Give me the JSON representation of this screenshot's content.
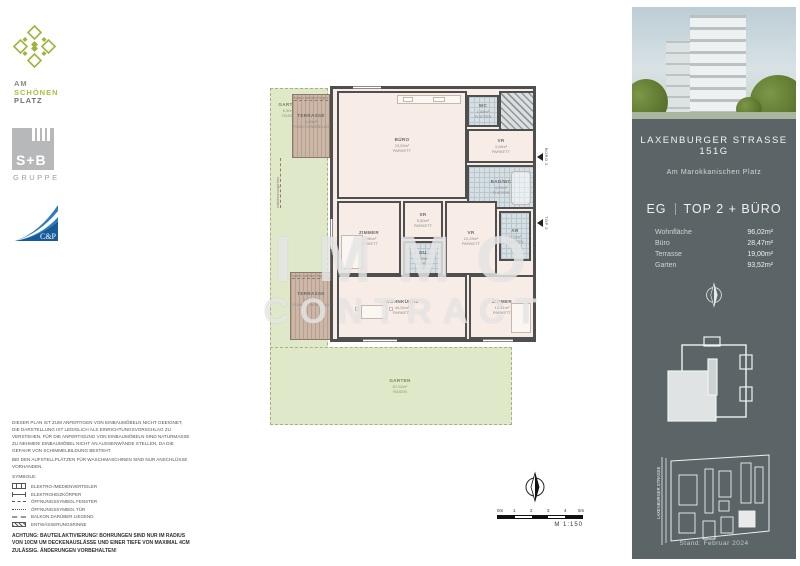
{
  "brand": {
    "asp": {
      "l1": "AM",
      "l2": "SCHÖNEN",
      "l3": "PLATZ"
    },
    "sb_name": "S+B",
    "sb_sub": "GRUPPE",
    "cp": "C&P"
  },
  "plan": {
    "rooms": [
      {
        "name": "BÜRO",
        "area": "23,53m²",
        "floor": "PARKETT"
      },
      {
        "name": "WC",
        "area": "1,88m²",
        "floor": "FLIESEN"
      },
      {
        "name": "VR",
        "area": "3,06m²",
        "floor": "PARKETT"
      },
      {
        "name": "BAD/WC",
        "area": "4,50m²",
        "floor": "FLIESEN"
      },
      {
        "name": "ZIMMER",
        "area": "12,96m²",
        "floor": "PARKETT"
      },
      {
        "name": "SR",
        "area": "5,50m²",
        "floor": "PARKETT"
      },
      {
        "name": "DU",
        "area": "4,00m²",
        "floor": "FLIESEN"
      },
      {
        "name": "VR",
        "area": "10,29m²",
        "floor": "PARKETT"
      },
      {
        "name": "AR",
        "area": "1,70m²",
        "floor": "FLIESEN"
      },
      {
        "name": "WOHNKÜCHE",
        "area": "44,24m²",
        "floor": "PARKETT"
      },
      {
        "name": "ZIMMER",
        "area": "12,41m²",
        "floor": "PARKETT"
      }
    ],
    "outdoor": [
      {
        "name": "GARTEN",
        "area": "6,50m²",
        "floor": "RASEN"
      },
      {
        "name": "TERRASSE",
        "area": "6,56m²",
        "floor": "FUNKTIONSBELAG"
      },
      {
        "name": "TERRASSE",
        "area": "12,44m²",
        "floor": "FUNKTIONSBELAG"
      },
      {
        "name": "GARTEN",
        "area": "87,02m²",
        "floor": "RASEN"
      }
    ],
    "note_balcony": "balkon darüber liegend",
    "note_drain": "entwässerungsrinne",
    "entrance_top": "BÜRO 2",
    "entrance_main": "TOP 2",
    "watermark": {
      "line1": "IMMO",
      "line2": "CONTRACT"
    }
  },
  "scalebar": {
    "ticks": [
      "0m",
      "1",
      "2",
      "3",
      "4",
      "5m"
    ],
    "scale": "M 1:150"
  },
  "sidebar": {
    "title": "LAXENBURGER STRASSE 151G",
    "subtitle": "Am Marokkanischen Platz",
    "unit_floor": "EG",
    "unit_name": "TOP 2 + BÜRO",
    "areas": [
      {
        "label": "Wohnfläche",
        "value": "96,02m²"
      },
      {
        "label": "Büro",
        "value": "28,47m²"
      },
      {
        "label": "Terrasse",
        "value": "19,00m²"
      },
      {
        "label": "Garten",
        "value": "93,52m²"
      }
    ],
    "street": "LAXENBURGER STRASSE",
    "stand": "Stand: Februar 2024"
  },
  "footer": {
    "p1": "DIESER PLAN IST ZUM ANFERTIGEN VON EINBAUMÖBELN NICHT GEEIGNET, DIE DARSTELLUNG IST LEDIGLICH ALS EINRICHTUNGSVORSCHLAG ZU VERSTEHEN. FÜR DIE ANFERTIGUNG VON EINBAUMÖBELN SIND NATURMASSE ZU NEHMEN! EINBAUMÖBEL NICHT AN AUSSENWÄNDE STELLEN, DA DIE GEFAHR VON SCHIMMELBILDUNG BESTEHT.",
    "p2": "BEI DEN AUFSTELLPLÄTZEN FÜR WASCHMASCHINEN SIND NUR ANSCHLÜSSE VORHANDEN.",
    "symbols_title": "SYMBOLE:",
    "legend": [
      "ELEKTRO-/MEDIENVERTEILER",
      "ELEKTROHEIZKÖRPER",
      "ÖFFNUNGSSYMBOL FENSTER",
      "ÖFFNUNGSSYMBOL TÜR",
      "BALKON DARÜBER LIEGEND",
      "ENTWÄSSERUNGSRINNE"
    ],
    "achtung": "ACHTUNG: BAUTEILAKTIVIERUNG! BOHRUNGEN SIND NUR IM RADIUS VON 10CM UM DECKENAUSLÄSSE  UND EINER TIEFE VON MAXIMAL 4CM ZULÄSSIG. ÄNDERUNGEN VORBEHALTEN!"
  },
  "colors": {
    "sidebar_bg": "#5b6568",
    "logo_green": "#9cb53c",
    "cp_blue": "#1b75bb",
    "garden": "#dfe8c8",
    "terrace": "#ccb6a6",
    "room_fill": "#f8ece7",
    "wall": "#4f4f4f",
    "tile": "#d6dfe3"
  }
}
